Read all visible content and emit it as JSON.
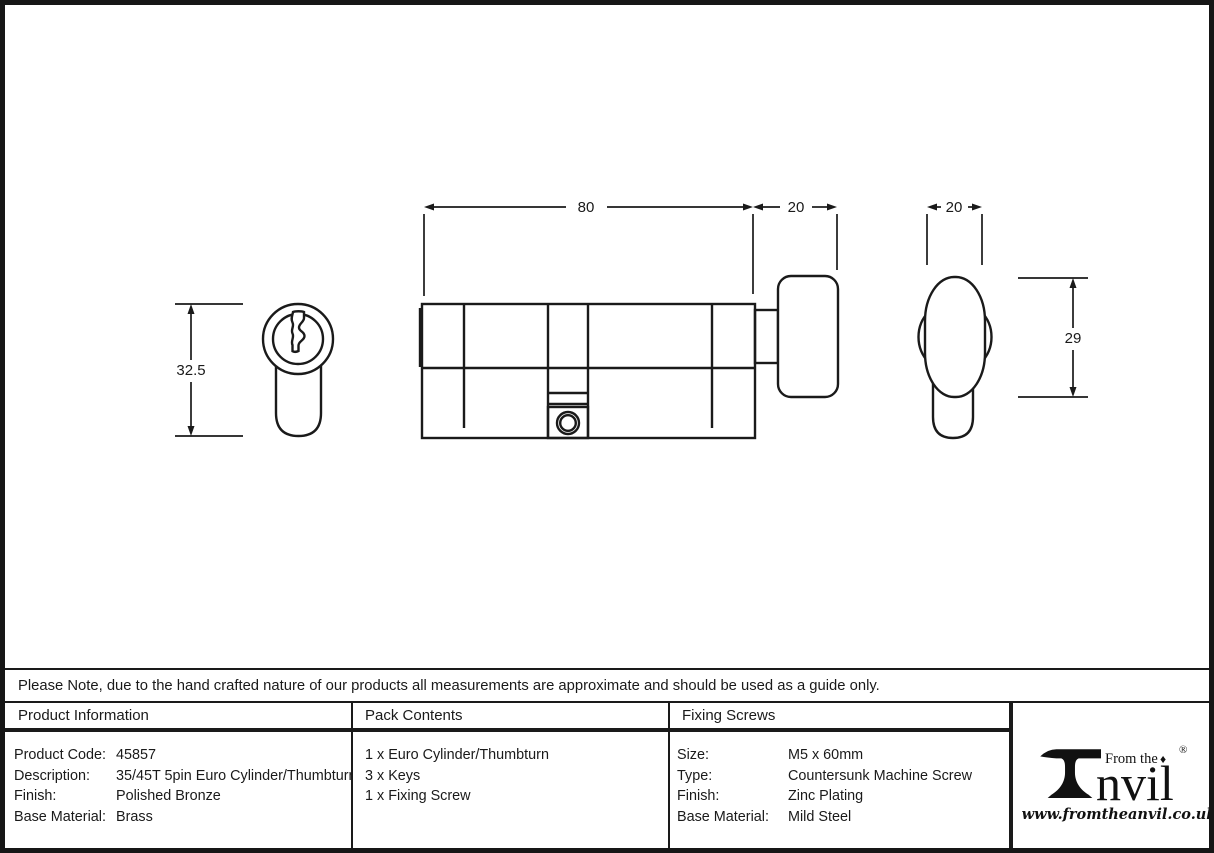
{
  "colors": {
    "line": "#1a1a1a",
    "background": "#ffffff"
  },
  "drawing": {
    "dims": {
      "body_length": "80",
      "thumbturn_length": "20",
      "thumbturn_width": "20",
      "face_height": "32.5",
      "knob_height": "29"
    }
  },
  "note_text": "Please Note, due to the hand crafted nature of our products all measurements are approximate and should be used as a guide only.",
  "table": {
    "product_info": {
      "header": "Product Information",
      "rows": [
        {
          "label": "Product Code:",
          "value": "45857"
        },
        {
          "label": "Description:",
          "value": "35/45T 5pin Euro Cylinder/Thumbturn"
        },
        {
          "label": "Finish:",
          "value": "Polished Bronze"
        },
        {
          "label": "Base Material:",
          "value": "Brass"
        }
      ]
    },
    "pack_contents": {
      "header": "Pack Contents",
      "items": [
        "1 x Euro Cylinder/Thumbturn",
        "3 x Keys",
        "1 x Fixing Screw"
      ]
    },
    "fixing_screws": {
      "header": "Fixing Screws",
      "rows": [
        {
          "label": "Size:",
          "value": "M5 x 60mm"
        },
        {
          "label": "Type:",
          "value": "Countersunk Machine Screw"
        },
        {
          "label": "Finish:",
          "value": "Zinc Plating"
        },
        {
          "label": "Base Material:",
          "value": "Mild Steel"
        }
      ]
    }
  },
  "logo": {
    "from_the": "From the",
    "brand_suffix": "nvil",
    "registered": "®",
    "diamond": "♦",
    "website": "www.fromtheanvil.co.uk"
  }
}
